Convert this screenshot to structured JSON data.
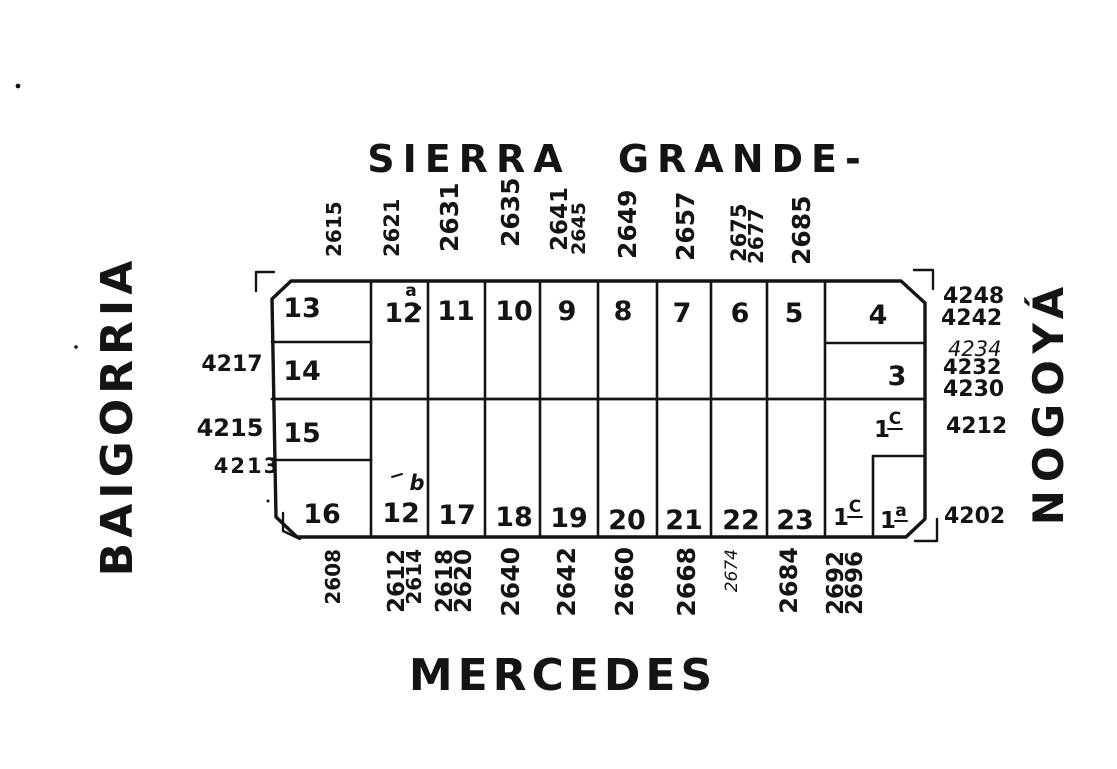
{
  "streets": {
    "top": "SIERRA GRANDE-",
    "bottom": "MERCEDES",
    "left": "BAIGORRIA",
    "right": "NOGOYÁ"
  },
  "top_numbers": [
    "2615",
    "2621",
    "2631",
    "2635",
    "2641",
    "2645",
    "2649",
    "2657",
    "2675",
    "2677",
    "2685"
  ],
  "bottom_numbers": [
    "2608",
    "2612",
    "2614",
    "2618",
    "2620",
    "2640",
    "2642",
    "2660",
    "2668",
    "2674",
    "2684",
    "2692",
    "2696"
  ],
  "left_numbers": [
    "4217",
    "4215",
    "4213"
  ],
  "right_numbers": [
    "4248",
    "4242",
    "4234",
    "4232",
    "4230",
    "4212",
    "4202"
  ],
  "lots": {
    "l13": "13",
    "l12a": "12",
    "l12a_sup": "a",
    "l11": "11",
    "l10": "10",
    "l9": "9",
    "l8": "8",
    "l7": "7",
    "l6": "6",
    "l5": "5",
    "l4": "4",
    "l14": "14",
    "l3": "3",
    "l15": "15",
    "l1c_upper_base": "1",
    "l1c_upper_sup": "C",
    "l16": "16",
    "l12b": "12",
    "l12b_sup": "b",
    "l17": "17",
    "l18": "18",
    "l19": "19",
    "l20": "20",
    "l21": "21",
    "l22": "22",
    "l23": "23",
    "l1c_lower_base": "1",
    "l1c_lower_sup": "C",
    "l1a_base": "1",
    "l1a_sup": "a"
  },
  "colors": {
    "ink": "#141414",
    "paper": "#ffffff"
  }
}
